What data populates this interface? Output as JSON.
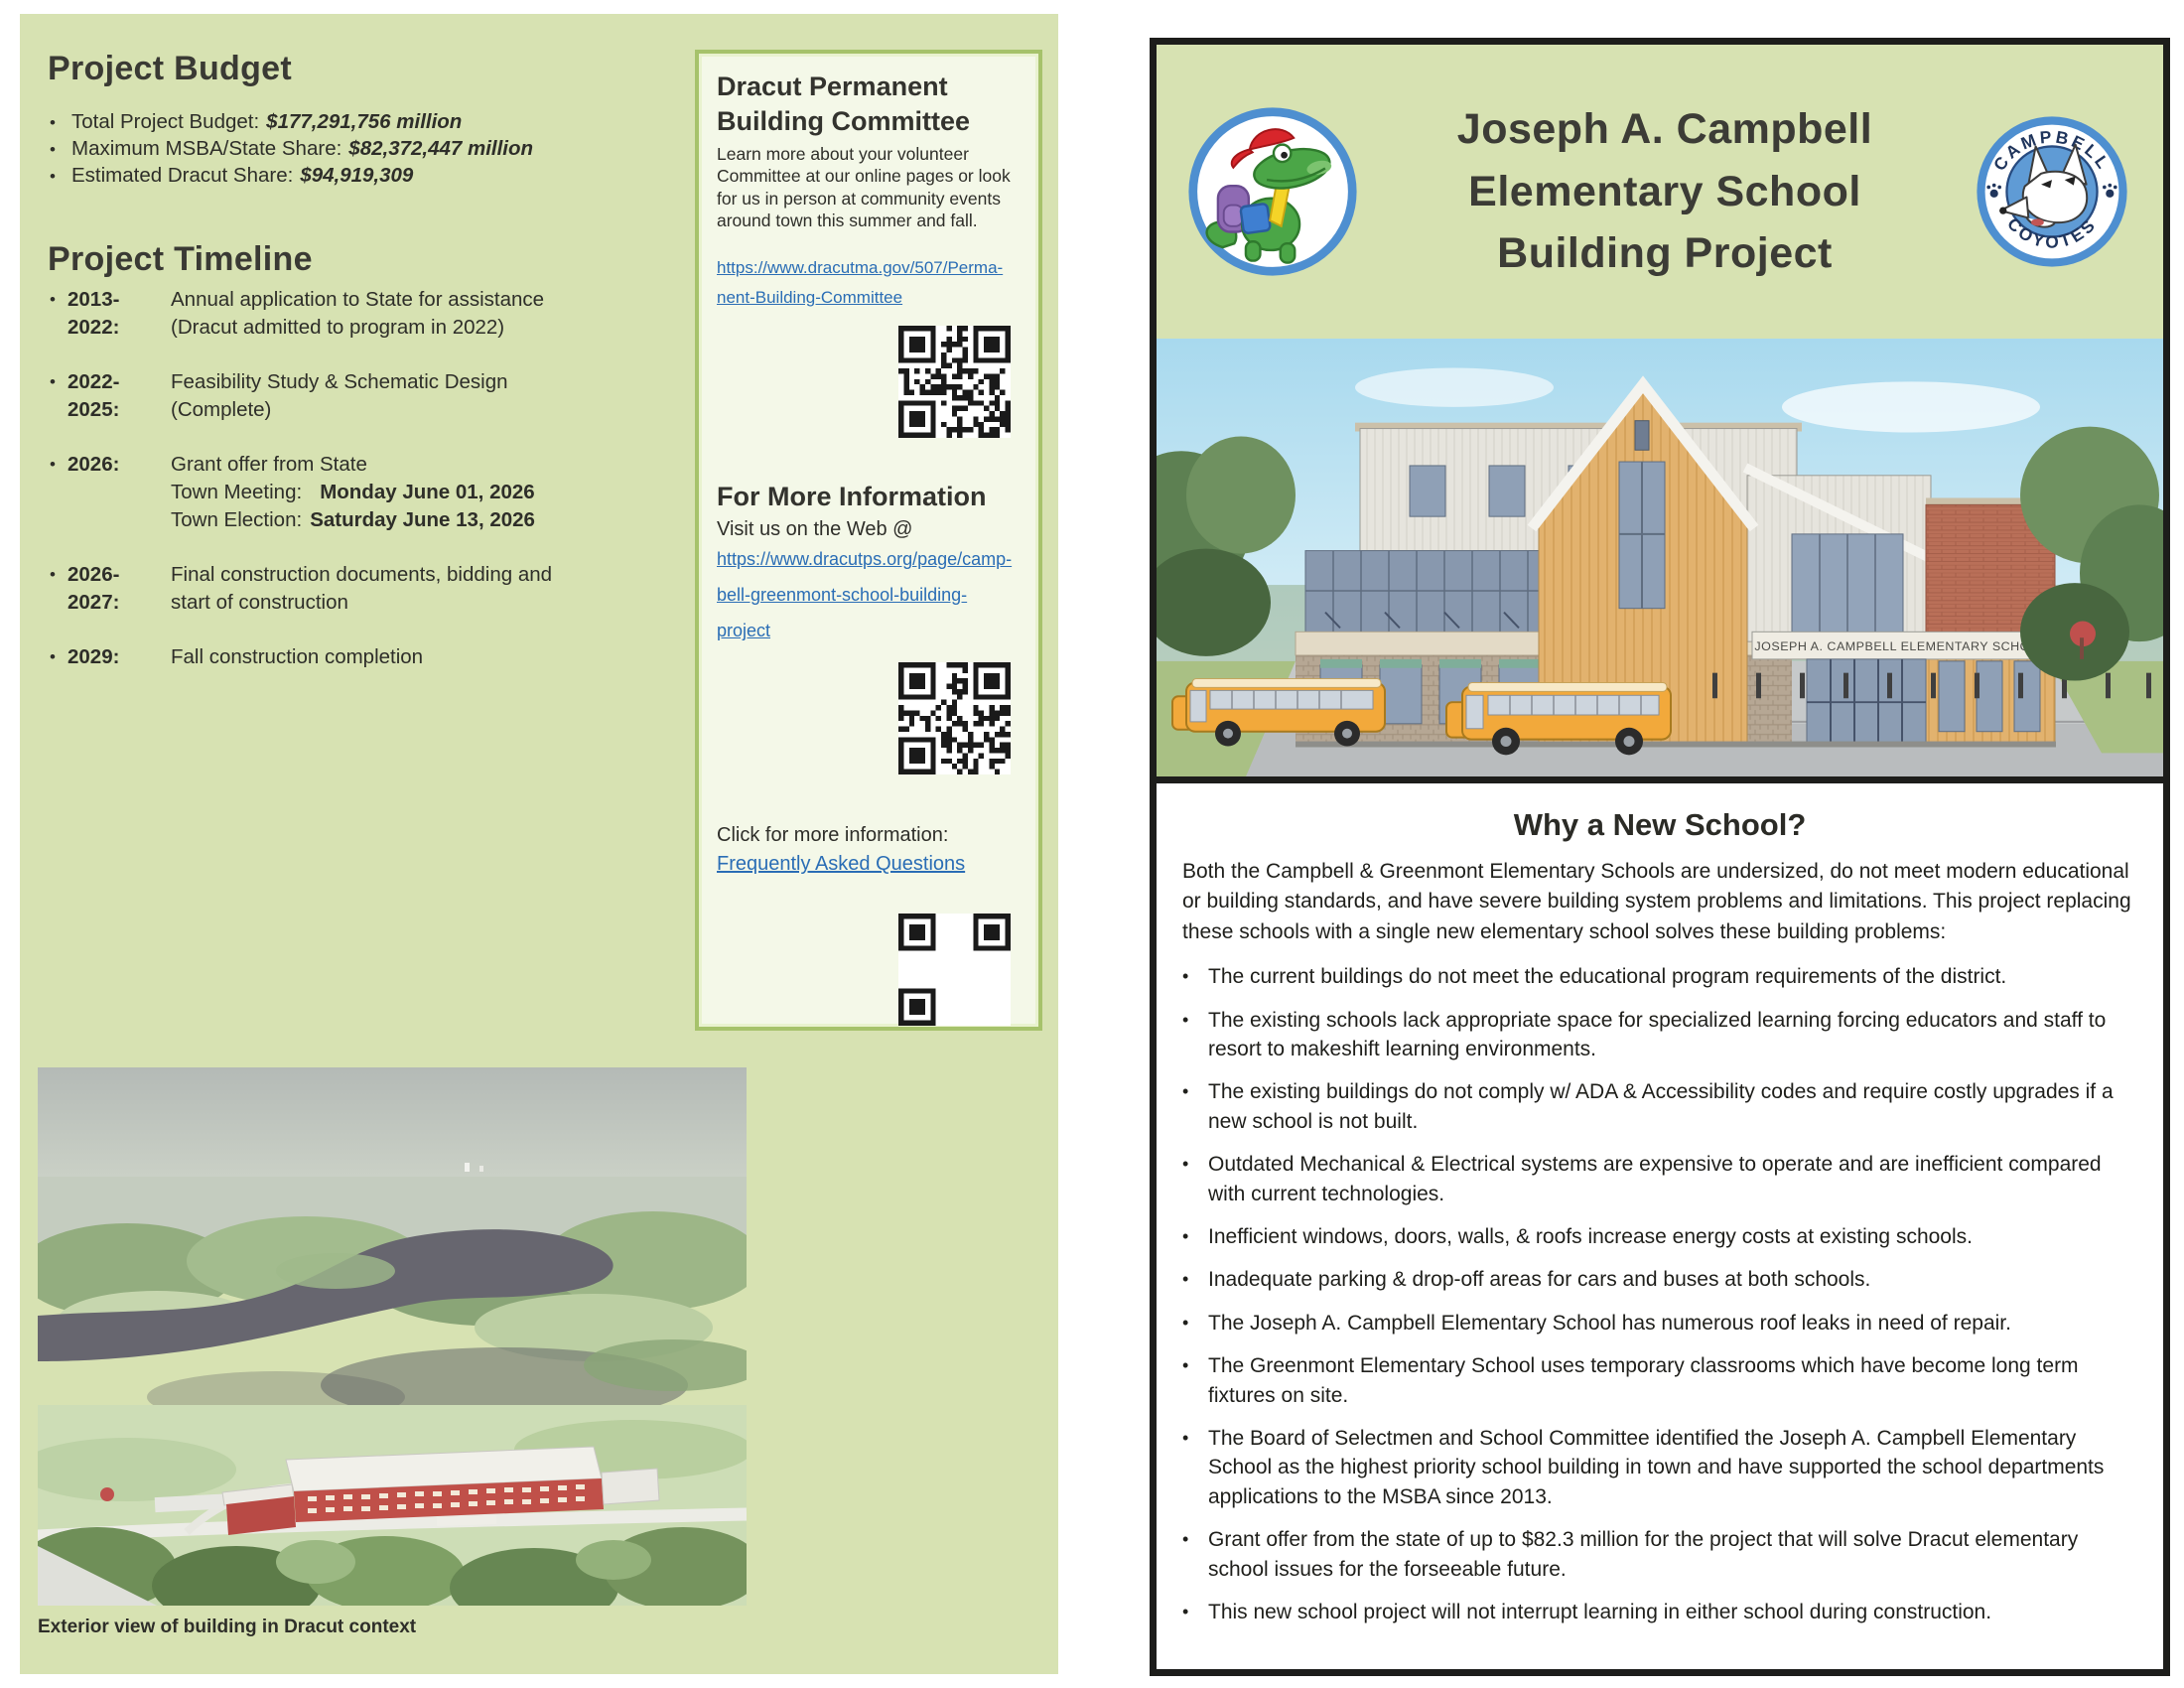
{
  "colors": {
    "page_green": "#d7e2b2",
    "box_bg": "#f4f8e8",
    "box_border": "#a6c26b",
    "link_blue": "#2a6db5",
    "page_border": "#1d1d1b",
    "logo_ring_blue": "#4e8fd0",
    "bus_yellow": "#f2a93b",
    "brick_red": "#b96f58"
  },
  "left_page": {
    "budget": {
      "title": "Project Budget",
      "items": [
        {
          "label": "Total Project Budget:",
          "value": "$177,291,756 million"
        },
        {
          "label": "Maximum MSBA/State Share:",
          "value": "$82,372,447 million"
        },
        {
          "label": "Estimated Dracut Share:",
          "value": "$94,919,309"
        }
      ]
    },
    "timeline": {
      "title": "Project Timeline",
      "items": [
        {
          "year": "2013-2022:",
          "line1": "Annual application to State for assistance",
          "line2": "(Dracut admitted to program in 2022)"
        },
        {
          "year": "2022-2025:",
          "line1": "Feasibility Study & Schematic Design",
          "line2": "(Complete)"
        },
        {
          "year": "2026:",
          "line1": "Grant offer from State",
          "meeting_label": "Town Meeting:",
          "meeting_date": "Monday June 01, 2026",
          "election_label": "Town Election:",
          "election_date": "Saturday June 13, 2026"
        },
        {
          "year": "2026-2027:",
          "line1": "Final construction documents, bidding and",
          "line2": "start of construction"
        },
        {
          "year": "2029:",
          "line1": "Fall construction completion"
        }
      ]
    },
    "aerial_caption": "Exterior view of building in Dracut context"
  },
  "committee_box": {
    "title": "Dracut Permanent Building Committee",
    "intro": "Learn more about your volunteer Committee at our online pages or look for us in person at community events around town this summer and fall.",
    "link_line1": "https://www.dracutma.gov/507/Perma-",
    "link_line2": "nent-Building-Committee",
    "more_info_title": "For More Information",
    "web_label": "Visit us on the Web @",
    "web_link_line1": "https://www.dracutps.org/page/camp-",
    "web_link_line2": "bell-greenmont-school-building-project",
    "click_label": "Click for more information:",
    "faq_link": "Frequently Asked Questions"
  },
  "right_page": {
    "title_line1": "Joseph A. Campbell",
    "title_line2": "Elementary School",
    "title_line3": "Building Project",
    "coyote_logo": {
      "top": "CAMPBELL",
      "bottom": "COYOTES"
    },
    "building_sign": "JOSEPH A. CAMPBELL ELEMENTARY SCHOOL",
    "why": {
      "title": "Why a New School?",
      "intro": "Both the Campbell & Greenmont Elementary Schools are undersized, do not meet modern educational or building standards, and have severe building system problems and limitations. This project replacing these schools with a single new elementary school solves these building problems:",
      "bullets": [
        "The current buildings do not meet the educational program requirements of the district.",
        "The existing schools lack appropriate space for specialized learning forcing educators and staff to resort to makeshift learning environments.",
        "The existing buildings do not comply w/ ADA & Accessibility codes and require costly upgrades if a new school is not built.",
        "Outdated Mechanical & Electrical systems are expensive to operate and are inefficient compared with current technologies.",
        "Inefficient windows, doors, walls, & roofs increase energy costs at existing schools.",
        "Inadequate parking & drop-off areas for cars and buses at both schools.",
        "The Joseph A. Campbell Elementary School has numerous roof leaks in need of repair.",
        "The Greenmont Elementary School uses temporary classrooms which have become long term fixtures on site.",
        "The Board of Selectmen and School Committee identified the Joseph A. Campbell Elementary School as the highest priority school building in town and have supported the school departments applications to the MSBA since 2013.",
        "Grant offer from the state of up to $82.3 million for the project that will solve Dracut elementary school issues for the forseeable future.",
        "This new school project will not interrupt learning in either school during construction."
      ]
    }
  }
}
